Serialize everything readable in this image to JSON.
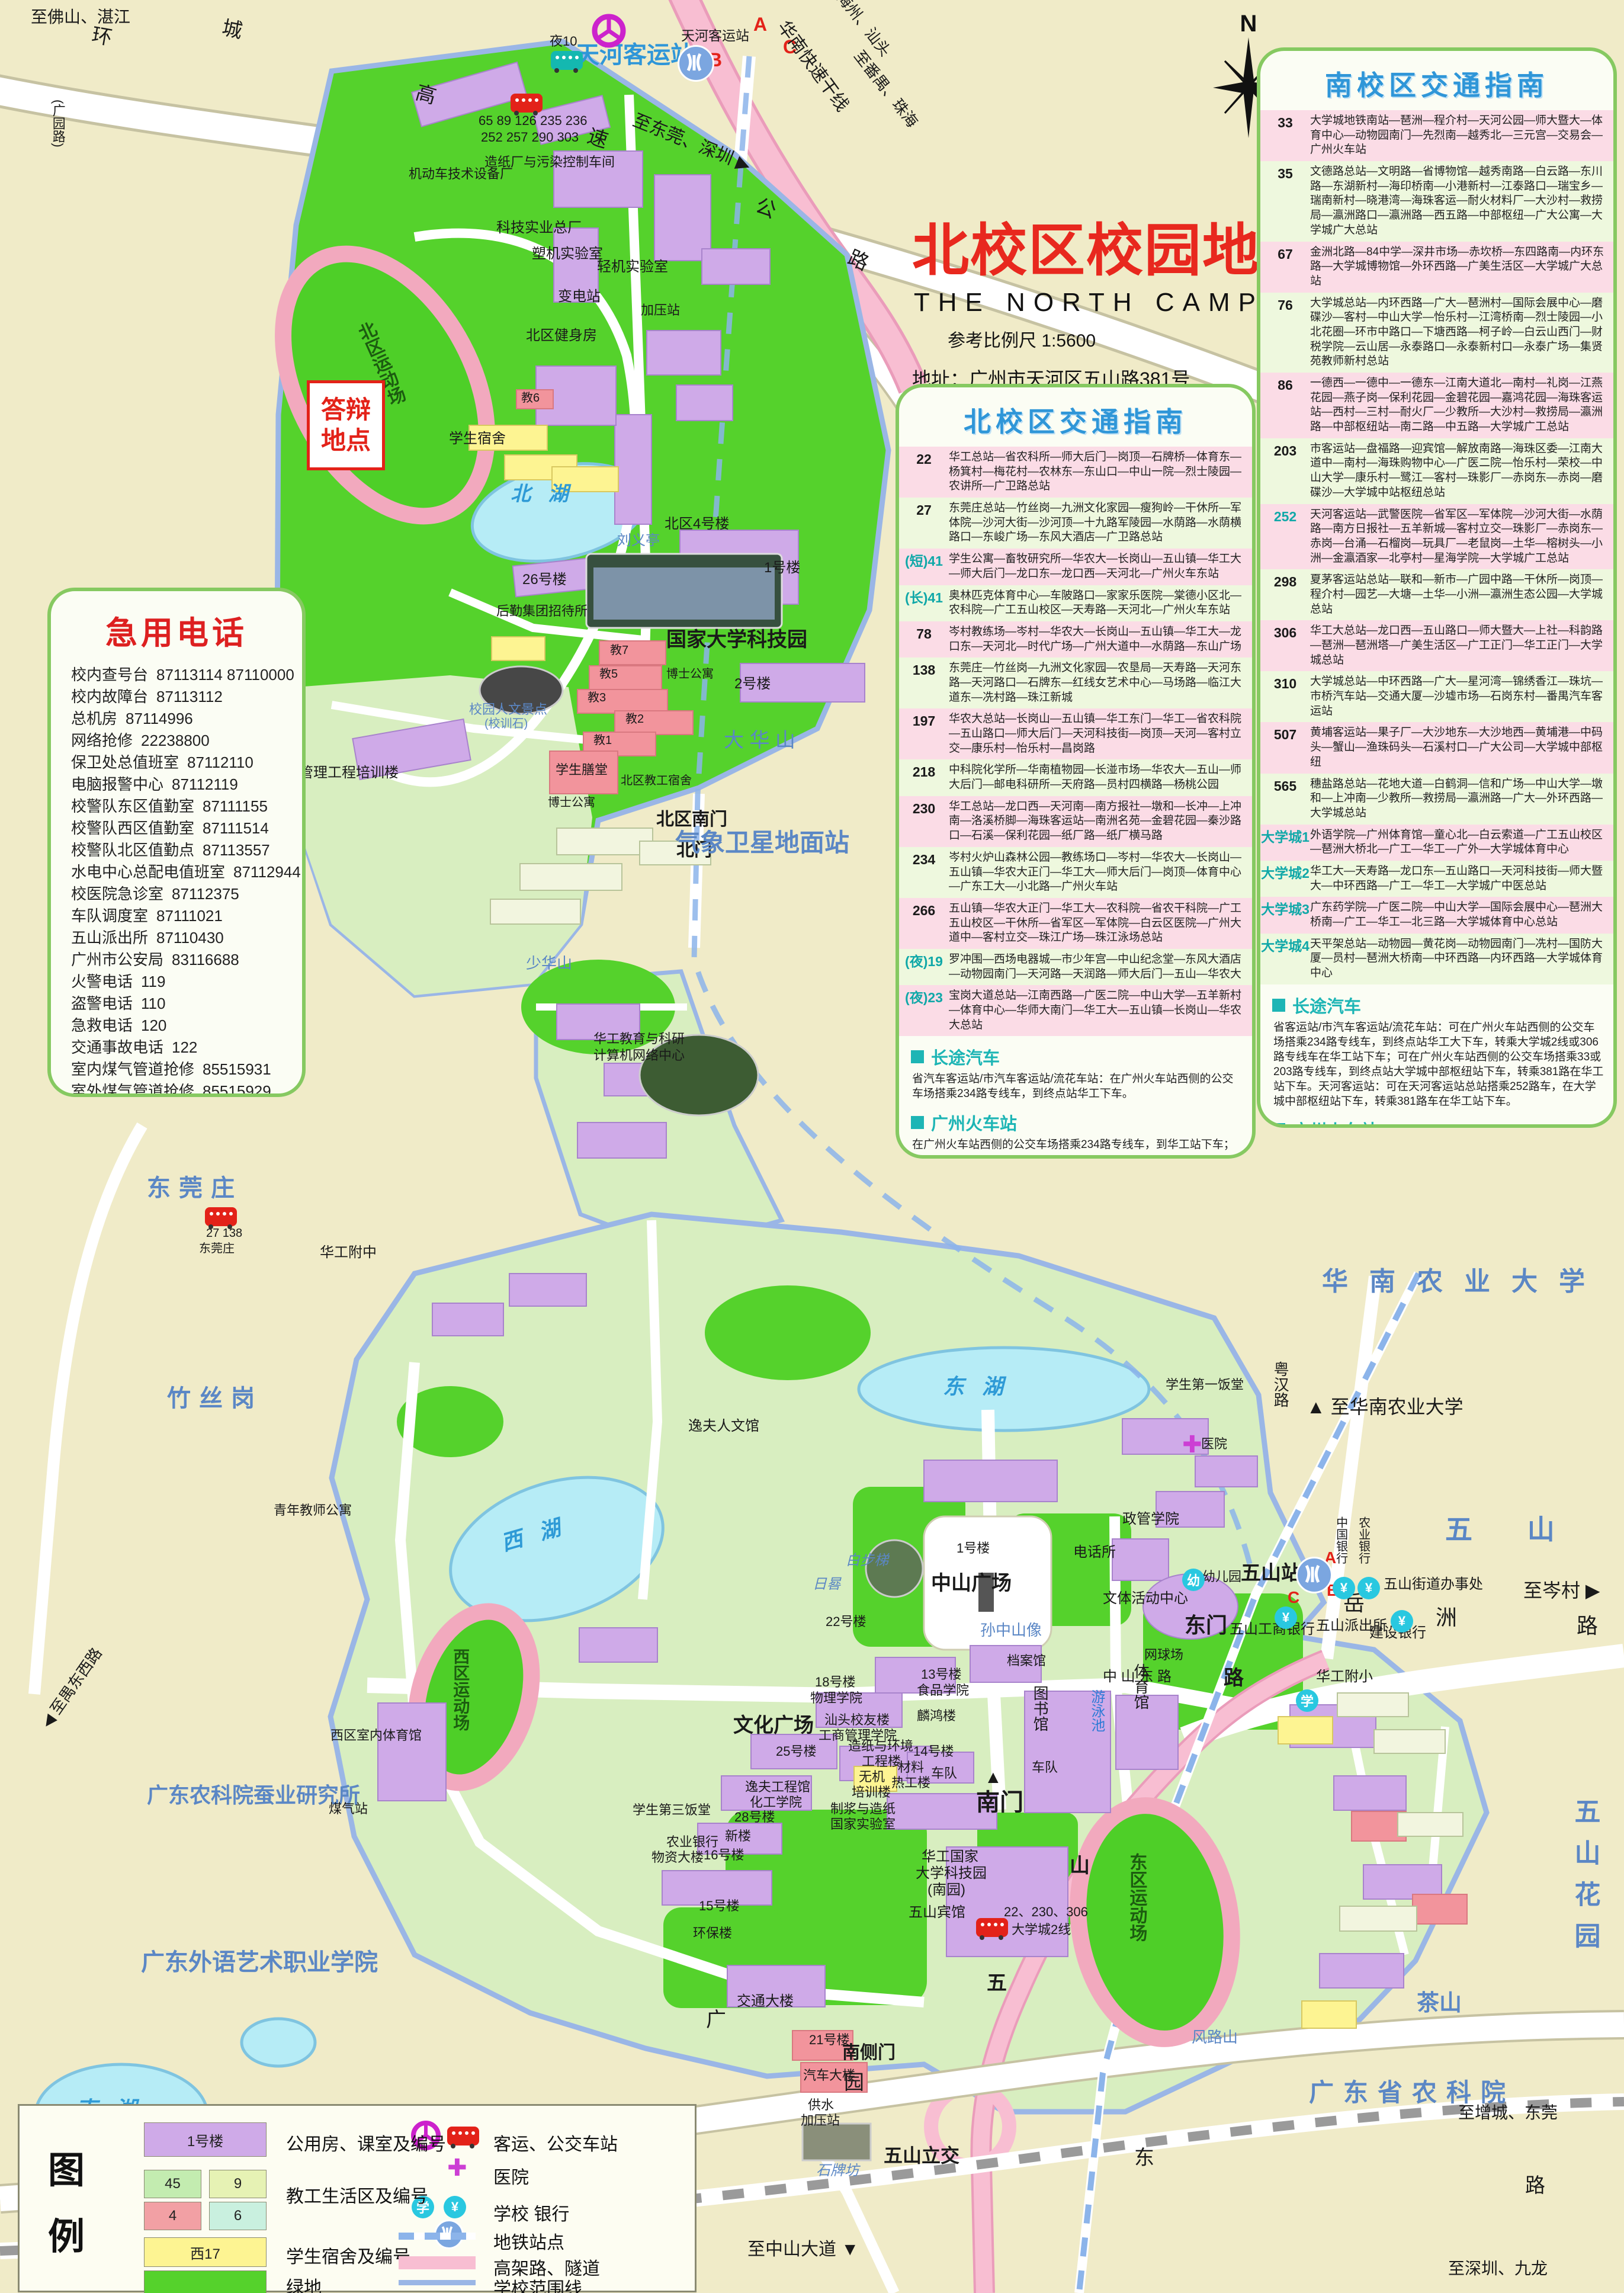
{
  "title": {
    "zh": "北校区校园地图",
    "en": "THE NORTH CAMPUS",
    "scale": "参考比例尺   1:5600",
    "address": "地址：广州市天河区五山路381号",
    "postcode": "邮编：510640",
    "website": "网址：Http://www.scut.edu.cn"
  },
  "compass": {
    "label": "N"
  },
  "icons": {
    "school": "学",
    "bank": "¥",
    "hospital": "✚",
    "kindergarten": "幼",
    "traffic": "交"
  },
  "emergency": {
    "title": "急用电话",
    "entries": [
      {
        "label": "校内查号台",
        "number": "87113114  87110000"
      },
      {
        "label": "校内故障台",
        "number": "87113112"
      },
      {
        "label": "总机房",
        "number": "87114996"
      },
      {
        "label": "网络抢修",
        "number": "22238800"
      },
      {
        "label": "保卫处总值班室",
        "number": "87112110"
      },
      {
        "label": "电脑报警中心",
        "number": "87112119"
      },
      {
        "label": "校警队东区值勤室",
        "number": "87111155"
      },
      {
        "label": "校警队西区值勤室",
        "number": "87111514"
      },
      {
        "label": "校警队北区值勤点",
        "number": "87113557"
      },
      {
        "label": "水电中心总配电值班室",
        "number": "87112944"
      },
      {
        "label": "校医院急诊室",
        "number": "87112375"
      },
      {
        "label": "车队调度室",
        "number": "87111021"
      },
      {
        "label": "五山派出所",
        "number": "87110430"
      },
      {
        "label": "广州市公安局",
        "number": "83116688"
      },
      {
        "label": "火警电话",
        "number": "119"
      },
      {
        "label": "盗警电话",
        "number": "110"
      },
      {
        "label": "急救电话",
        "number": "120"
      },
      {
        "label": "交通事故电话",
        "number": "122"
      },
      {
        "label": "室内煤气管道抢修",
        "number": "85515931"
      },
      {
        "label": "室外煤气管道抢修",
        "number": "85515929"
      }
    ]
  },
  "north_guide": {
    "title": "北校区交通指南",
    "routes": [
      {
        "no": "22",
        "path": "华工总站—省农科所—师大后门—岗顶—石牌桥—体育东—杨箕村—梅花村—农林东—东山口—中山一院—烈士陵园—农讲所—广卫路总站"
      },
      {
        "no": "27",
        "path": "东莞庄总站—竹丝岗—九洲文化家园—瘦狗岭—干休所—军体院—沙河大街—沙河顶—十九路军陵园—水荫路—水荫横路口—东峻广场—东风大酒店—广卫路总站"
      },
      {
        "no": "(短)41",
        "path": "学生公寓—畜牧研究所—华农大—长岗山—五山镇—华工大—师大后门—龙口东—龙口西—天河北—广州火车东站"
      },
      {
        "no": "(长)41",
        "path": "奥林匹克体育中心—车陂路口—家家乐医院—棠德小区北—农科院—广工五山校区—天寿路—天河北—广州火车东站"
      },
      {
        "no": "78",
        "path": "岑村教练场—岑村—华农大—长岗山—五山镇—华工大—龙口东—天河北—时代广场—广州大道中—水荫路—东山广场"
      },
      {
        "no": "138",
        "path": "东莞庄—竹丝岗—九洲文化家园—农垦局—天寿路—天河东路—天河路口—石牌东—红线女艺术中心—马场路—临江大道东—冼村路—珠江新城"
      },
      {
        "no": "197",
        "path": "华农大总站—长岗山—五山镇—华工东门—华工—省农科院—五山路口—师大后门—天河科技街—岗顶—天河—客村立交—康乐村—怡乐村—昌岗路"
      },
      {
        "no": "218",
        "path": "中科院化学所—华南植物园—长湴市场—华农大—五山—师大后门—邮电科研所—天府路—员村四横路—杨桃公园"
      },
      {
        "no": "230",
        "path": "华工总站—龙口西—天河南—南方报社—墩和—长冲—上冲南—洛溪桥脚—海珠客运站—南洲名苑—金碧花园—秦沙路口—石溪—保利花园—纸厂路—纸厂横马路"
      },
      {
        "no": "234",
        "path": "岑村火炉山森林公园—教练场口—岑村—华农大—长岗山—五山镇—华农大正门—华工大—师大后门—岗顶—体育中心—广东工大—小北路—广州火车站"
      },
      {
        "no": "266",
        "path": "五山镇—华农大正门—华工大—农科院—省农干科院—广工五山校区—干休所—省军区—军体院—白云区医院—广州大道中—客村立交—珠江广场—珠江泳场总站"
      },
      {
        "no": "(夜)19",
        "path": "罗冲围—西场电器城—市少年宫—中山纪念堂—东风大酒店—动物园南门—天河路—天润路—师大后门—五山—华农大"
      },
      {
        "no": "(夜)23",
        "path": "宝岗大道总站—江南西路—广医二院—中山大学—五羊新村—体育中心—华师大南门—华工大—五山镇—长岗山—华农大总站"
      }
    ],
    "sections": [
      {
        "h": "长途汽车",
        "t": "省汽车客运站/市汽车客运站/流花车站：在广州火车站西侧的公交车场搭乘234路专线车，到终点站华工下车。"
      },
      {
        "h": "广州火车站",
        "t": "在广州火车站西侧的公交车场搭乘234路专线车，到华工站下车；"
      },
      {
        "h": "广州火车东站",
        "t": "在广州火车东站搭乘41路短线专线车，到华工站下车；"
      },
      {
        "h": "白云国际机场",
        "t": "可乘新机场快线4号线，到华工站下车；（黄埔每小时正点发车）"
      },
      {
        "h": "地铁",
        "t": "广州火车站/省汽车客运站/市汽车客运站/流花车站：从火车站乘坐地铁至公园前转地铁1号线至体育西站，再转乘地铁3号线至五山站；火车东站/锦汉车站：乘坐地铁至体育西站转乘地铁3号线（天河客运站方向）至五山站；天河客运站：站外马路对面就是华南理工大学主校区北门，或者坐地铁至五山站"
      },
      {
        "h": "客运码头",
        "t": "如在大沙头客运码头登岸，可乘7路公交车到广州火车站转车搭234路；如果由黄埔客运码头上岸，可坐火车站方向的公车，在岗顶站下车，转乘22路、234路均可。"
      }
    ]
  },
  "south_guide": {
    "title": "南校区交通指南",
    "routes": [
      {
        "no": "33",
        "path": "大学城地铁南站—琶洲—程介村—天河公园—师大暨大—体育中心—动物园南门—先烈南—越秀北—三元宫—交易会—广州火车站"
      },
      {
        "no": "35",
        "path": "文德路总站—文明路—省博物馆—越秀南路—白云路—东川路—东湖新村—海印桥南—小港新村—江泰路口—瑞宝乡—瑞南新村—晓港湾—海珠客运—耐火材料厂—大沙村—救捞局—瀛洲路口—瀛洲路—西五路—中部枢纽—广大公寓—大学城广大总站"
      },
      {
        "no": "67",
        "path": "金洲北路—84中学—深井市场—赤坎桥—东四路南—内环东路—大学城博物馆—外环西路—广美生活区—大学城广大总站"
      },
      {
        "no": "76",
        "path": "大学城总站—内环西路—广大—琶洲村—国际会展中心—磨碟沙—客村—中山大学—怡乐村—江湾桥南—烈士陵园—小北花圈—环市中路口—下塘西路—柯子岭—白云山西门—财税学院—云山居—永泰路口—永泰新村口—永泰广场—集贤苑教师新村总站"
      },
      {
        "no": "86",
        "path": "一德西—一德中—一德东—江南大道北—南村—礼岗—江燕花园—燕子岗—保利花园—金碧花园—嘉鸿花园—海珠客运站—西村—三村—耐火厂—少教所—大沙村—救捞局—瀛洲路—中部枢纽站—南二路—中五路—大学城广工总站"
      },
      {
        "no": "203",
        "path": "市客运站—盘福路—迎宾馆—解放南路—海珠区委—江南大道中—南村—海珠购物中心—广医二院—怡乐村—荣校—中山大学—康乐村—鹭江—客村—珠影厂—赤岗东—赤岗—磨碟沙—大学城中站枢纽总站"
      },
      {
        "no": "252",
        "path": "天河客运站—武警医院—省军区—军体院—沙河大街—水荫路—南方日报社—五羊新城—客村立交—珠影厂—赤岗东—赤岗—台涌—石榴岗—玩具厂—老鼠岗—土华—榕树头—小洲—金瀛酒家—北亭村—星海学院—大学城广工总站"
      },
      {
        "no": "298",
        "path": "夏茅客运站总站—联和—新市—广园中路—干休所—岗顶—程介村—园艺—大塘—土华—小洲—瀛洲生态公园—大学城总站"
      },
      {
        "no": "306",
        "path": "华工大总站—龙口西—五山路口—师大暨大—上社—科韵路—琶洲—琶洲塔—广美生活区—广工正门—华工正门—大学城总站"
      },
      {
        "no": "310",
        "path": "大学城总站—中环西路—广大—星河湾—锦绣香江—珠坑—市桥汽车站—交通大厦—沙墟市场—石岗东村—番禺汽车客运站"
      },
      {
        "no": "507",
        "path": "黄埔客运站—果子厂—大沙地东—大沙地西—黄埔港—中码头—蟹山—渔珠码头—石溪村口—广大公司—大学城中部枢纽"
      },
      {
        "no": "565",
        "path": "穗盐路总站—花地大道—白鹤洞—信和广场—中山大学—墩和—上冲南—少教所—救捞局—瀛洲路—广大—外环西路—大学城总站"
      },
      {
        "no": "大学城1",
        "path": "外语学院—广州体育馆—童心北—白云索道—广工五山校区—琶洲大桥北—广工—华工—广外—大学城体育中心"
      },
      {
        "no": "大学城2",
        "path": "华工大—天寿路—龙口东—五山路口—天河科技街—师大暨大—中环西路—广工—华工—大学城广中医总站"
      },
      {
        "no": "大学城3",
        "path": "广东药学院—广医二院—中山大学—国际会展中心—琶洲大桥南—广工—华工—北三路—大学城体育中心总站"
      },
      {
        "no": "大学城4",
        "path": "天平架总站—动物园—黄花岗—动物园南门—冼村—国防大厦—员村—琶洲大桥南—中环西路—内环西路—大学城体育中心"
      }
    ],
    "sections": [
      {
        "h": "长途汽车",
        "t": "省客运站/市汽车客运站/流花车站：可在广州火车站西侧的公交车场搭乘234路专线车，到终点站华工大下车，转乘大学城2线或306路专线车在华工站下车；可在广州火车站西侧的公交车场搭乘33或203路专线车，到终点站大学城中部枢纽站下车，转乘381路在华工站下车。天河客运站：可在天河客运站总站搭乘252路车，在大学城中部枢纽站下车，转乘381路车在华工站下车。"
      },
      {
        "h": "广州火车站",
        "t": "可在广州火车站西侧的公交车场搭乘234路专线车，到终点站华工大下车，转乘大学城2线或306路专线车在华工站下车；可在广州火车站西侧的公交车场搭乘33或203路专线车，到终点站大学城中部枢纽站下车，转乘381路在华工站下车。"
      },
      {
        "h": "广州火车东站",
        "t": "可在广州火车东站搭乘515路专线车，在师大暨大站下车，转乘大学城2线、306路到华工站下车，或搭乘33路、298路专线车到大学城中部枢纽站下车，转乘381路车到华工站下车。"
      },
      {
        "h": "白云国际机场",
        "t": "可乘新机场快线1号线，到边检站下车；转乘298路车到广园中站下车，再乘大学城1号线，到大学城华工站下车。"
      },
      {
        "h": "地铁",
        "t": "广州火车站/省汽车客运站/市汽车客运站/流花车站：从火车站乘坐地铁至万胜围站转乘地铁大学城专线至大学城南站；火车东站/锦汉车站：乘坐地铁3号线至客村站转乘地铁2号线至万胜围站，然后转乘地铁大学城专线至大学城南站；天河客运站：乘坐地铁3号线至客村站转乘地铁2号线至万胜围站，然后转乘地铁大学城专线至大学城南站"
      }
    ]
  },
  "legend": {
    "title_chars": [
      "图",
      "例"
    ],
    "items_left": [
      {
        "swatch": "1号楼",
        "label": "公用房、课室及编号"
      },
      {
        "s1": "45",
        "s2": "9",
        "s3": "4",
        "s4": "6",
        "label": "教工生活区及编号"
      },
      {
        "swatch": "西17",
        "label": "学生宿舍及编号"
      },
      {
        "swatch": "",
        "label": "绿地"
      }
    ],
    "items_right": [
      {
        "label": "客运、公交车站"
      },
      {
        "label": "医院"
      },
      {
        "label": "学校   银行"
      },
      {
        "label": "地铁站点"
      },
      {
        "label": "高架路、隧道"
      },
      {
        "label": "学校范围线"
      }
    ]
  },
  "map": {
    "labels": [
      {
        "t": "天河客运站"
      },
      {
        "t": "天河客运站"
      },
      {
        "t": "夜10"
      },
      {
        "t": "65 89 126 235 236"
      },
      {
        "t": "252 257 290 303"
      },
      {
        "t": "A"
      },
      {
        "t": "B"
      },
      {
        "t": "C"
      },
      {
        "t": "至佛山、湛江"
      },
      {
        "t": "(广园路)"
      },
      {
        "t": "环"
      },
      {
        "t": "城"
      },
      {
        "t": "高"
      },
      {
        "t": "速"
      },
      {
        "t": "公"
      },
      {
        "t": "路"
      },
      {
        "t": "华南快速干线"
      },
      {
        "t": "至梅州、汕头"
      },
      {
        "t": "至番禺、珠海"
      },
      {
        "t": "至东莞、深圳 ▶"
      },
      {
        "t": "机动车技术设备厂"
      },
      {
        "t": "造纸厂与污染控制车间"
      },
      {
        "t": "科技实业总厂"
      },
      {
        "t": "塑机实验室"
      },
      {
        "t": "轻机实验室"
      },
      {
        "t": "变电站"
      },
      {
        "t": "加压站"
      },
      {
        "t": "北区健身房"
      },
      {
        "t": "教6"
      },
      {
        "t": "学生宿舍"
      },
      {
        "t": "北区运动场"
      },
      {
        "t": "答辩"
      },
      {
        "t": "地点"
      },
      {
        "t": "管理工程培训楼"
      },
      {
        "t": "北 湖"
      },
      {
        "t": "刘义亭"
      },
      {
        "t": "北区4号楼"
      },
      {
        "t": "1号楼"
      },
      {
        "t": "国家大学科技园"
      },
      {
        "t": "2号楼"
      },
      {
        "t": "26号楼"
      },
      {
        "t": "后勤集团招待所"
      },
      {
        "t": "教7"
      },
      {
        "t": "教5"
      },
      {
        "t": "教3"
      },
      {
        "t": "教2"
      },
      {
        "t": "教1"
      },
      {
        "t": "博士公寓"
      },
      {
        "t": "学生膳堂"
      },
      {
        "t": "博士公寓"
      },
      {
        "t": "北区教工宿舍"
      },
      {
        "t": "校园人文景点"
      },
      {
        "t": "(校训石)"
      },
      {
        "t": "北区南门"
      },
      {
        "t": "北门"
      },
      {
        "t": "大 华 山"
      },
      {
        "t": "气象卫星地面站"
      },
      {
        "t": "华工教育与科研"
      },
      {
        "t": "计算机网络中心"
      },
      {
        "t": "华工附中"
      },
      {
        "t": "东莞庄"
      },
      {
        "t": "竹丝岗"
      },
      {
        "t": "广东农科院蚕业研究所"
      },
      {
        "t": "广东外语艺术职业学院"
      },
      {
        "t": "少华山"
      },
      {
        "t": "西 湖"
      },
      {
        "t": "东  湖"
      },
      {
        "t": "南 湖"
      },
      {
        "t": "中山广场"
      },
      {
        "t": "孙中山像"
      },
      {
        "t": "白步梯"
      },
      {
        "t": "22号楼"
      },
      {
        "t": "1号楼"
      },
      {
        "t": "电话所"
      },
      {
        "t": "政管学院"
      },
      {
        "t": "文体活动中心"
      },
      {
        "t": "东门"
      },
      {
        "t": "幼儿园"
      },
      {
        "t": "网球场"
      },
      {
        "t": "体育馆"
      },
      {
        "t": "游泳池"
      },
      {
        "t": "档案馆"
      },
      {
        "t": "图书馆"
      },
      {
        "t": "车队"
      },
      {
        "t": "车队"
      },
      {
        "t": "13号楼"
      },
      {
        "t": "食品学院"
      },
      {
        "t": "18号楼"
      },
      {
        "t": "物理学院"
      },
      {
        "t": "汕头校友楼"
      },
      {
        "t": "工商管理学院"
      },
      {
        "t": "造纸与环境"
      },
      {
        "t": "工程楼"
      },
      {
        "t": "无机"
      },
      {
        "t": "培训楼"
      },
      {
        "t": "材料"
      },
      {
        "t": "热工楼"
      },
      {
        "t": "麟鸿楼"
      },
      {
        "t": "14号楼"
      },
      {
        "t": "制浆与造纸"
      },
      {
        "t": "国家实验室"
      },
      {
        "t": "文化广场"
      },
      {
        "t": "25号楼"
      },
      {
        "t": "逸夫工程馆"
      },
      {
        "t": "化工学院"
      },
      {
        "t": "28号楼"
      },
      {
        "t": "新楼"
      },
      {
        "t": "16号楼"
      },
      {
        "t": "农业银行"
      },
      {
        "t": "物资大楼"
      },
      {
        "t": "学生第三饭堂"
      },
      {
        "t": "15号楼"
      },
      {
        "t": "环保楼"
      },
      {
        "t": "交通大楼"
      },
      {
        "t": "逸夫人文馆"
      },
      {
        "t": "西区运动场"
      },
      {
        "t": "西区室内体育馆"
      },
      {
        "t": "煤气站"
      },
      {
        "t": "东区运动场"
      },
      {
        "t": "华工国家"
      },
      {
        "t": "大学科技园"
      },
      {
        "t": "(南园)"
      },
      {
        "t": "五山宾馆"
      },
      {
        "t": "南门"
      },
      {
        "t": "南侧门"
      },
      {
        "t": "21号楼"
      },
      {
        "t": "汽车大楼"
      },
      {
        "t": "供水"
      },
      {
        "t": "加压站"
      },
      {
        "t": "石牌坊"
      },
      {
        "t": "五山立交"
      },
      {
        "t": "至中山大道 ▼"
      },
      {
        "t": "22、230、306"
      },
      {
        "t": "大学城2线"
      },
      {
        "t": "27 138"
      },
      {
        "t": "东莞庄"
      },
      {
        "t": "学生第一饭堂"
      },
      {
        "t": "医院"
      },
      {
        "t": "华工附小"
      },
      {
        "t": "五山派出所"
      },
      {
        "t": "建设银行"
      },
      {
        "t": "五山工商银行"
      },
      {
        "t": "五山街道办事处"
      },
      {
        "t": "中国银行"
      },
      {
        "t": "农业银行"
      },
      {
        "t": "五山站"
      },
      {
        "t": "A"
      },
      {
        "t": "B"
      },
      {
        "t": "C"
      },
      {
        "t": "至岑村 ▶"
      },
      {
        "t": "▲ 至华南农业大学"
      },
      {
        "t": "华南农业大学"
      },
      {
        "t": "五  山"
      },
      {
        "t": "岳"
      },
      {
        "t": "洲"
      },
      {
        "t": "路"
      },
      {
        "t": "粤汉路"
      },
      {
        "t": "中 山 东 路"
      },
      {
        "t": "五"
      },
      {
        "t": "山"
      },
      {
        "t": "路"
      },
      {
        "t": "五山花园"
      },
      {
        "t": "茶山"
      },
      {
        "t": "风路山"
      },
      {
        "t": "广东省农科院"
      },
      {
        "t": "至增城、东莞"
      },
      {
        "t": "至深圳、九龙"
      },
      {
        "t": "◀ 至禺东西路"
      },
      {
        "t": "广"
      },
      {
        "t": "园"
      },
      {
        "t": "东"
      },
      {
        "t": "路"
      },
      {
        "t": "▲"
      },
      {
        "t": "日晷"
      },
      {
        "t": "青年教师公寓"
      }
    ]
  }
}
